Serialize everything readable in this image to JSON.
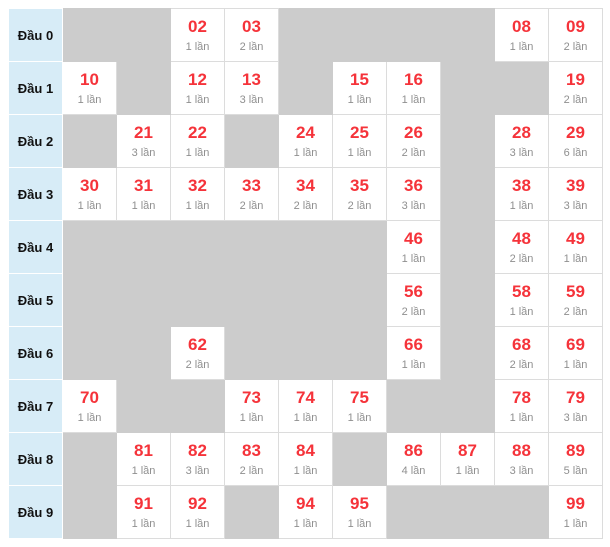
{
  "table": {
    "name": "lottery-head-digit-frequency",
    "colors": {
      "number_color": "#f5333a",
      "count_color": "#8f8f8f",
      "header_bg": "#d7ecf7",
      "empty_bg": "#cccccc",
      "filled_border": "#dcdcdc"
    },
    "rows": [
      {
        "label": "Đầu 0",
        "cells": [
          null,
          null,
          {
            "num": "02",
            "count": "1 lần"
          },
          {
            "num": "03",
            "count": "2 lần"
          },
          null,
          null,
          null,
          null,
          {
            "num": "08",
            "count": "1 lần"
          },
          {
            "num": "09",
            "count": "2 lần"
          }
        ]
      },
      {
        "label": "Đầu 1",
        "cells": [
          {
            "num": "10",
            "count": "1 lần"
          },
          null,
          {
            "num": "12",
            "count": "1 lần"
          },
          {
            "num": "13",
            "count": "3 lần"
          },
          null,
          {
            "num": "15",
            "count": "1 lần"
          },
          {
            "num": "16",
            "count": "1 lần"
          },
          null,
          null,
          {
            "num": "19",
            "count": "2 lần"
          }
        ]
      },
      {
        "label": "Đầu 2",
        "cells": [
          null,
          {
            "num": "21",
            "count": "3 lần"
          },
          {
            "num": "22",
            "count": "1 lần"
          },
          null,
          {
            "num": "24",
            "count": "1 lần"
          },
          {
            "num": "25",
            "count": "1 lần"
          },
          {
            "num": "26",
            "count": "2 lần"
          },
          null,
          {
            "num": "28",
            "count": "3 lần"
          },
          {
            "num": "29",
            "count": "6 lần"
          }
        ]
      },
      {
        "label": "Đầu 3",
        "cells": [
          {
            "num": "30",
            "count": "1 lần"
          },
          {
            "num": "31",
            "count": "1 lần"
          },
          {
            "num": "32",
            "count": "1 lần"
          },
          {
            "num": "33",
            "count": "2 lần"
          },
          {
            "num": "34",
            "count": "2 lần"
          },
          {
            "num": "35",
            "count": "2 lần"
          },
          {
            "num": "36",
            "count": "3 lần"
          },
          null,
          {
            "num": "38",
            "count": "1 lần"
          },
          {
            "num": "39",
            "count": "3 lần"
          }
        ]
      },
      {
        "label": "Đầu 4",
        "cells": [
          null,
          null,
          null,
          null,
          null,
          null,
          {
            "num": "46",
            "count": "1 lần"
          },
          null,
          {
            "num": "48",
            "count": "2 lần"
          },
          {
            "num": "49",
            "count": "1 lần"
          }
        ]
      },
      {
        "label": "Đầu 5",
        "cells": [
          null,
          null,
          null,
          null,
          null,
          null,
          {
            "num": "56",
            "count": "2 lần"
          },
          null,
          {
            "num": "58",
            "count": "1 lần"
          },
          {
            "num": "59",
            "count": "2 lần"
          }
        ]
      },
      {
        "label": "Đầu 6",
        "cells": [
          null,
          null,
          {
            "num": "62",
            "count": "2 lần"
          },
          null,
          null,
          null,
          {
            "num": "66",
            "count": "1 lần"
          },
          null,
          {
            "num": "68",
            "count": "2 lần"
          },
          {
            "num": "69",
            "count": "1 lần"
          }
        ]
      },
      {
        "label": "Đầu 7",
        "cells": [
          {
            "num": "70",
            "count": "1 lần"
          },
          null,
          null,
          {
            "num": "73",
            "count": "1 lần"
          },
          {
            "num": "74",
            "count": "1 lần"
          },
          {
            "num": "75",
            "count": "1 lần"
          },
          null,
          null,
          {
            "num": "78",
            "count": "1 lần"
          },
          {
            "num": "79",
            "count": "3 lần"
          }
        ]
      },
      {
        "label": "Đầu 8",
        "cells": [
          null,
          {
            "num": "81",
            "count": "1 lần"
          },
          {
            "num": "82",
            "count": "3 lần"
          },
          {
            "num": "83",
            "count": "2 lần"
          },
          {
            "num": "84",
            "count": "1 lần"
          },
          null,
          {
            "num": "86",
            "count": "4 lần"
          },
          {
            "num": "87",
            "count": "1 lần"
          },
          {
            "num": "88",
            "count": "3 lần"
          },
          {
            "num": "89",
            "count": "5 lần"
          }
        ]
      },
      {
        "label": "Đầu 9",
        "cells": [
          null,
          {
            "num": "91",
            "count": "1 lần"
          },
          {
            "num": "92",
            "count": "1 lần"
          },
          null,
          {
            "num": "94",
            "count": "1 lần"
          },
          {
            "num": "95",
            "count": "1 lần"
          },
          null,
          null,
          null,
          {
            "num": "99",
            "count": "1 lần"
          }
        ]
      }
    ]
  }
}
